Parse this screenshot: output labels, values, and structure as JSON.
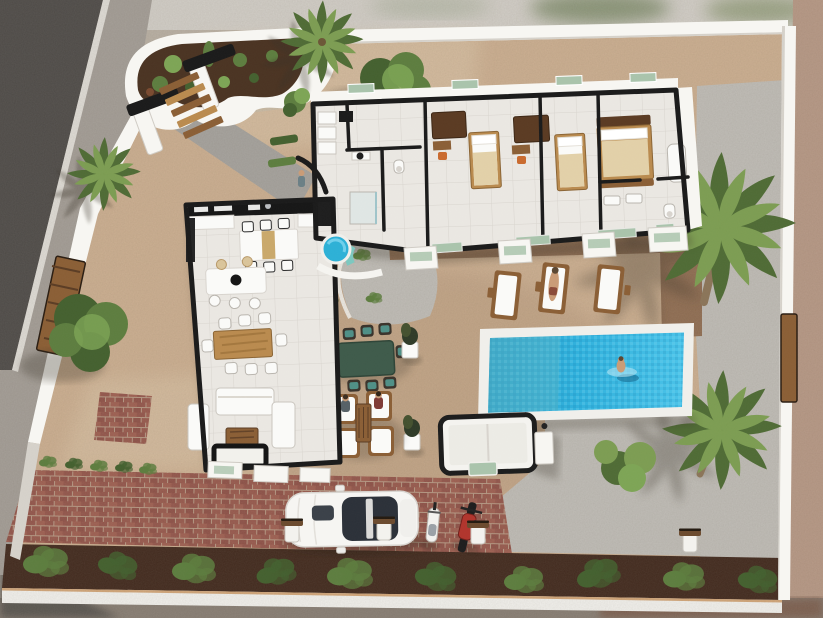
{
  "meta": {
    "type": "3d-architectural-aerial-render",
    "subject": "single-storey villa cutaway floor plan with garden, swimming pool, driveway and vehicles",
    "visible_text": "none"
  },
  "palette": {
    "sand": "#c9ac8e",
    "sandLight": "#d8c3a6",
    "sandDark": "#b4967a",
    "gravel": "#bdbab4",
    "road": "#4d4a47",
    "sidewalk": "#a19b94",
    "mulch": "#40281c",
    "curb": "#f0efeb",
    "terrace": "#8e6c51",
    "path": "#a3a09b",
    "wallWhite": "#f7f6f2",
    "wallShade": "#d5d1ca",
    "wallBlack": "#1a1a1a",
    "white": "#fafaf8",
    "floor": "#eae7e2",
    "floorLine": "#d8d4ce",
    "poolCoping": "#f1f0ec",
    "poolDeep": "#1f95c4",
    "poolLight": "#4fc2e8",
    "poolShallow": "#62b9c6",
    "jacuzzi": "#2cb0d6",
    "jacuzziDeck": "#7cc7bf",
    "glassGreen": "#a9c3ab",
    "bedding": "#e2d0a8",
    "woodLight": "#b98a4e",
    "woodMid": "#8a5e35",
    "woodDark": "#5a3a22",
    "orange": "#c96a2e",
    "tealCushion": "#4f8f86",
    "tableGreen": "#3e5a4a",
    "chairDark": "#3a332b",
    "skin": "#c99b76",
    "red": "#b0342c",
    "greenDark": "#44602f",
    "green": "#5d7d3f",
    "greenLight": "#7da455",
    "palmGreen": "#7c9c52",
    "palmDark": "#4f6b35",
    "brick": "#92544a",
    "brickLight": "#9d5e50",
    "mortar": "#b59782",
    "soil": "#4a3322",
    "carGlass": "#2b3038",
    "trunk": "#8a7458"
  },
  "scene": {
    "house": {
      "bedrooms": 3,
      "bathrooms": 2,
      "rooms": [
        "kitchen",
        "breakfast-bar",
        "dining-room",
        "living-room",
        "entrance-hall",
        "guest-bathroom",
        "bedroom-1",
        "bedroom-2",
        "master-bedroom",
        "ensuite-bathroom"
      ]
    },
    "outdoor_features": [
      "swimming-pool",
      "jacuzzi",
      "outbuilding",
      "outdoor-dining-set",
      "garden-lounge-set",
      "driveway",
      "entrance-gate-with-steps",
      "cactus-planter",
      "perimeter-wall",
      "gravel-areas",
      "mulch-garden-bed"
    ],
    "counts": {
      "sun_loungers": 3,
      "outdoor_dining_chairs": 8,
      "indoor_dining_chairs": 8,
      "lounge_chairs": 4,
      "palm_trees": 4,
      "olive_trees": 2,
      "garden_shrubs": 10,
      "bollard_posts": 4,
      "planter_pots": 2
    },
    "people": [
      {
        "location": "swimming-pool"
      },
      {
        "location": "middle-sun-lounger"
      },
      {
        "location": "lounge-chair-left"
      },
      {
        "location": "lounge-chair-right"
      },
      {
        "location": "front-door"
      }
    ],
    "vehicles": [
      "white-car",
      "white-scooter",
      "red-motorbike"
    ]
  }
}
